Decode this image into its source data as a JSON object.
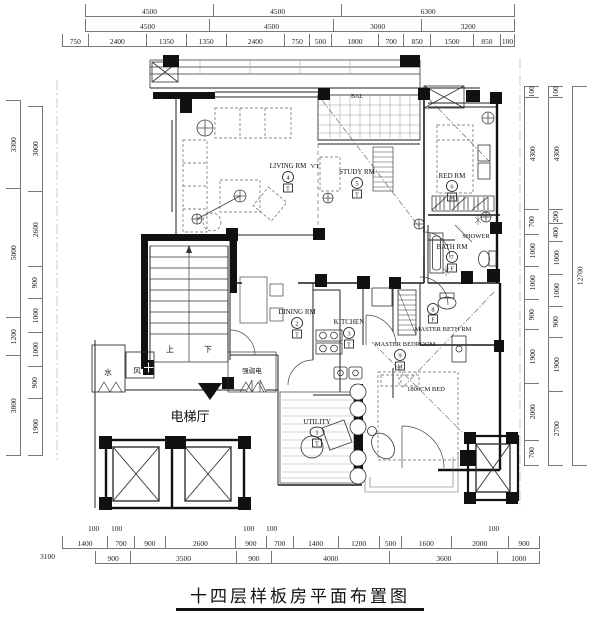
{
  "title": "十四层样板房平面布置图",
  "dims": {
    "top1": [
      "4500",
      "4500",
      "6300"
    ],
    "top2": [
      "4500",
      "4500",
      "3000",
      "3200"
    ],
    "top3": [
      "750",
      "2400",
      "1350",
      "1350",
      "2400",
      "750",
      "500",
      "1800",
      "700",
      "850",
      "1500",
      "850",
      "100"
    ],
    "left_outer": [
      "3300",
      "5000",
      "1200",
      "3800"
    ],
    "left_inner": [
      "3000",
      "2600",
      "900",
      "1000",
      "1000",
      "900",
      "1900"
    ],
    "right_a": [
      "100",
      "4300",
      "700",
      "1000",
      "1000",
      "900",
      "1900",
      "2000",
      "700"
    ],
    "right_b": [
      "100",
      "4300",
      "200",
      "400",
      "1000",
      "1000",
      "900",
      "1900",
      "2700"
    ],
    "right_c": [
      "12700"
    ],
    "bottom1": [
      "1400",
      "700",
      "900",
      "2600",
      "900",
      "700",
      "1400",
      "1200",
      "500",
      "1600",
      "2000",
      "900"
    ],
    "bottom2": [
      "900",
      "3500",
      "900",
      "4000",
      "3600",
      "1000"
    ],
    "b100": [
      "100",
      "100",
      "100",
      "100",
      "100"
    ],
    "b3100": "3100"
  },
  "rooms": {
    "utility": {
      "label": "UTILITY",
      "num": "1",
      "tag": "T"
    },
    "dining": {
      "label": "DINING RM",
      "num": "2",
      "tag": "T"
    },
    "kitchen": {
      "label": "KITCHEN",
      "num": "3",
      "tag": "T"
    },
    "living": {
      "label": "LIVING RM",
      "num": "4",
      "tag": "T"
    },
    "study": {
      "label": "STUDY RM",
      "num": "5",
      "tag": "T"
    },
    "bedroom2": {
      "label": "RED RM",
      "num": "6",
      "tag": "M"
    },
    "bath": {
      "label": "BATH RM",
      "num": "7",
      "tag": "F"
    },
    "master_bath": {
      "label": "MASTER BETH RM",
      "num": "8",
      "tag": "F"
    },
    "master_bedroom": {
      "label": "MASTER BEDROOM",
      "num": "9",
      "tag": "M"
    }
  },
  "annotations": {
    "shower": "SHOWER",
    "bed": "1800CM BED",
    "balcony": "BAL",
    "vt": "VT",
    "elevator_hall": "电梯厅",
    "stair_up": "上",
    "stair_down": "下",
    "water": "水",
    "wind": "风",
    "elec": "强弱电"
  },
  "colors": {
    "line": "#222",
    "wall": "#111",
    "furniture": "#666",
    "hatch": "#999"
  }
}
